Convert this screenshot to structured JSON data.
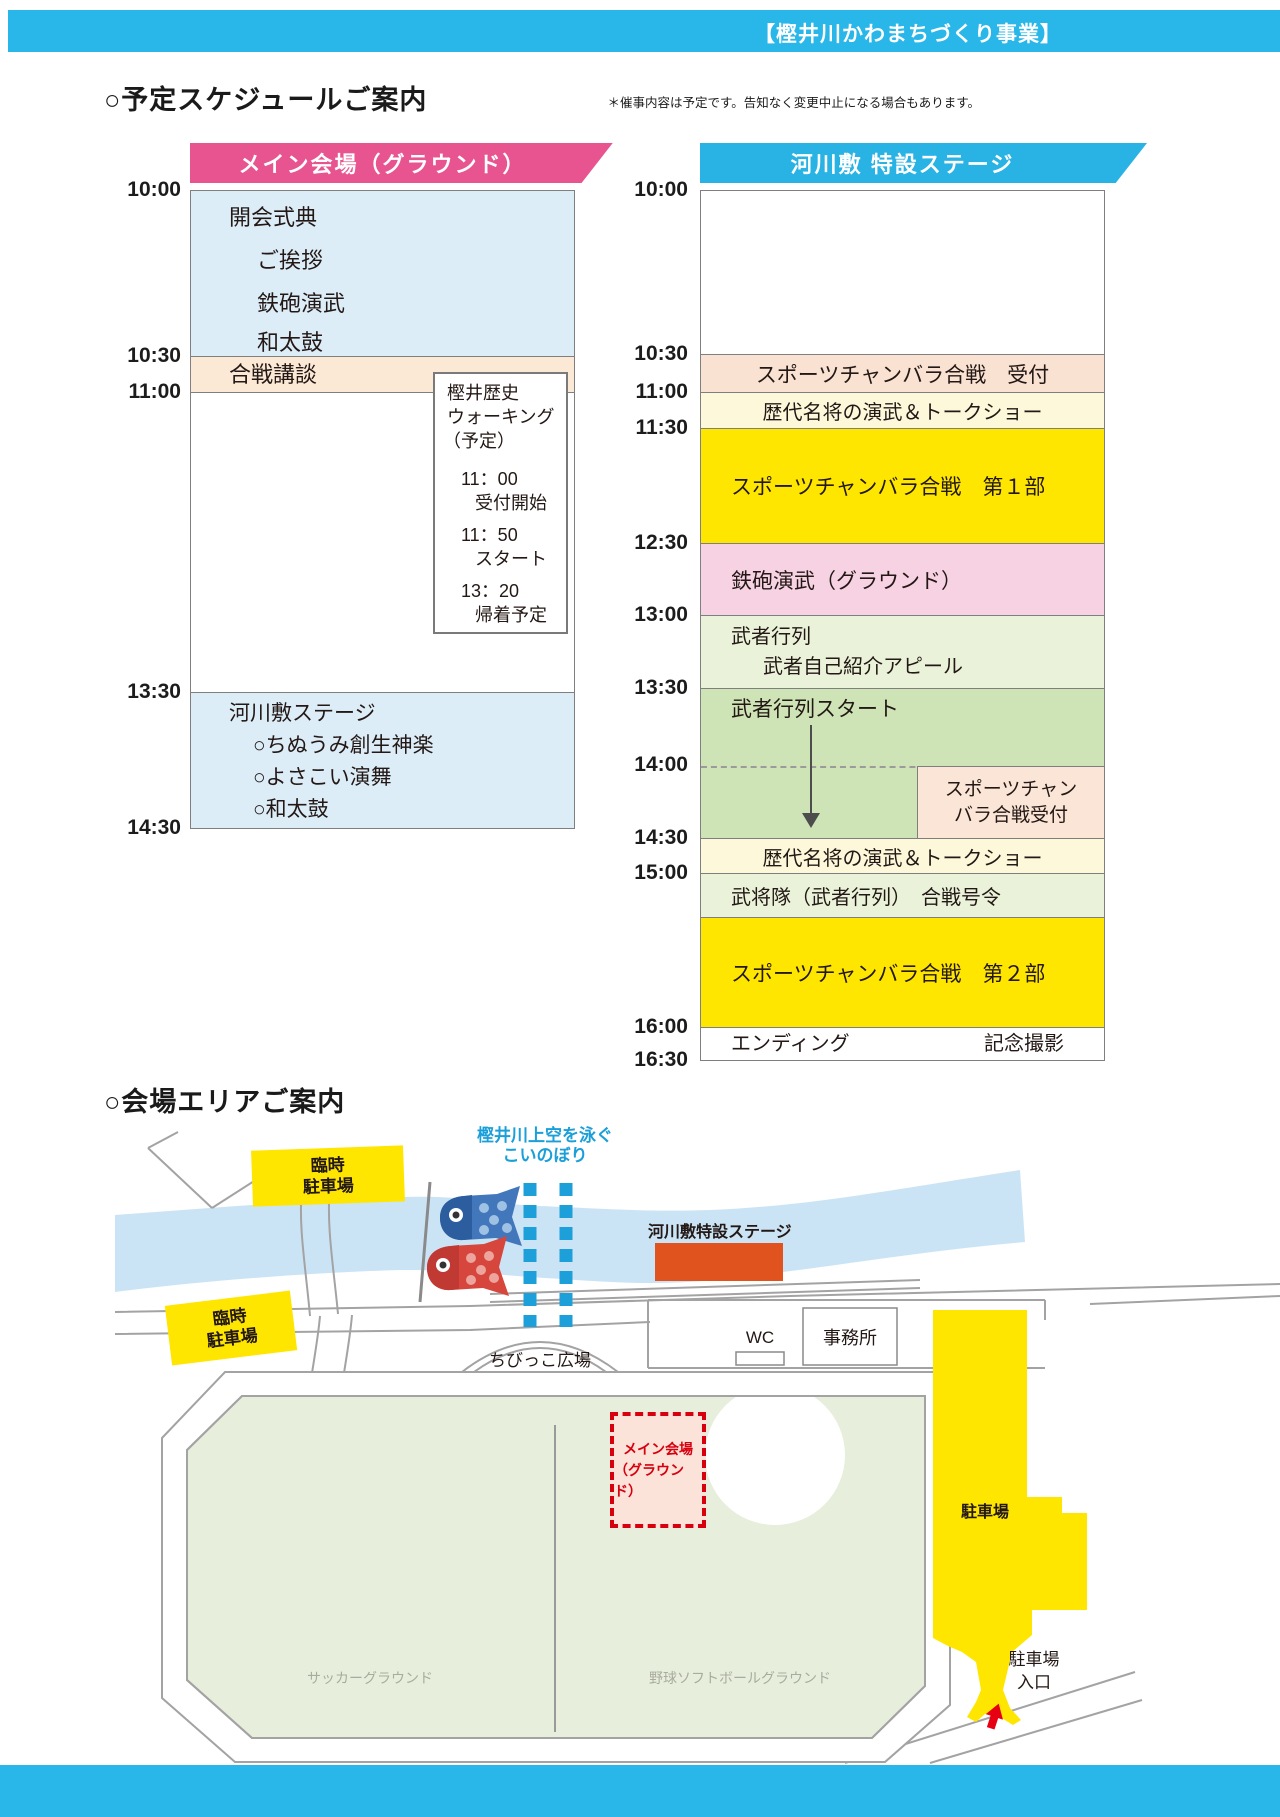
{
  "header": {
    "project_badge": "【樫井川かわまちづくり事業】"
  },
  "schedule": {
    "title": "○予定スケジュールご案内",
    "note": "＊催事内容は予定です。告知なく変更中止になる場合もあります。",
    "main_venue": {
      "banner": "メイン会場（グラウンド）",
      "time_labels": [
        "10:00",
        "10:30",
        "11:00",
        "13:30",
        "14:30"
      ],
      "opening_lines": [
        "開会式典",
        "ご挨拶",
        "鉄砲演武",
        "和太鼓"
      ],
      "kodan": "合戦講談",
      "walking_box": {
        "title_line1": "樫井歴史",
        "title_line2": "ウォーキング",
        "title_line3": "（予定）",
        "t1": "11：00",
        "l1": "受付開始",
        "t2": "11：50",
        "l2": "スタート",
        "t3": "13：20",
        "l3": "帰着予定"
      },
      "stage_block": [
        "河川敷ステージ",
        "○ちぬうみ創生神楽",
        "○よさこい演舞",
        "○和太鼓"
      ]
    },
    "river_stage": {
      "banner": "河川敷 特設ステージ",
      "time_labels": [
        "10:00",
        "10:30",
        "11:00",
        "11:30",
        "12:30",
        "13:00",
        "13:30",
        "14:00",
        "14:30",
        "15:00",
        "16:00",
        "16:30"
      ],
      "rows": {
        "reception1": "スポーツチャンバラ合戦　受付",
        "talkshow1": "歴代名将の演武＆トークショー",
        "chanbara1": "スポーツチャンバラ合戦　第１部",
        "teppo": "鉄砲演武（グラウンド）",
        "musha1a": "武者行列",
        "musha1b": "武者自己紹介アピール",
        "musha_start": "武者行列スタート",
        "reception2a": "スポーツチャン",
        "reception2b": "バラ合戦受付",
        "talkshow2": "歴代名将の演武＆トークショー",
        "bushotai": "武将隊（武者行列）　合戦号令",
        "chanbara2": "スポーツチャンバラ合戦　第２部",
        "ending": "エンディング",
        "photo": "記念撮影"
      }
    }
  },
  "map": {
    "title": "○会場エリアご案内",
    "temp_parking1_line1": "臨時",
    "temp_parking1_line2": "駐車場",
    "temp_parking2_line1": "臨時",
    "temp_parking2_line2": "駐車場",
    "koinobori_line1": "樫井川上空を泳ぐ",
    "koinobori_line2": "こいのぼり",
    "stage_label": "河川敷特設ステージ",
    "wc": "WC",
    "office": "事務所",
    "kids_plaza": "ちびっこ広場",
    "main_venue_line1": "メイン会場",
    "main_venue_line2": "（グラウンド）",
    "soccer": "サッカーグラウンド",
    "baseball": "野球ソフトボールグラウンド",
    "parking": "駐車場",
    "entrance_line1": "駐車場",
    "entrance_line2": "入口"
  },
  "colors": {
    "header_blue": "#29b6e8",
    "main_banner_pink": "#e8548f",
    "stage_banner_blue": "#29b3e4",
    "light_blue_block": "#dcedf8",
    "peach_block": "#fbe9d6",
    "pale_yellow_block": "#fdf8da",
    "highlight_yellow": "#ffe600",
    "pink_block": "#f6d2e2",
    "pale_green_block": "#eaf3da",
    "green_block": "#cee4b6",
    "river_blue": "#cbe4f5",
    "field_green": "#e7efdc",
    "stage_orange": "#e0531f",
    "map_red": "#d7000f",
    "map_label_blue": "#1b9fd8"
  }
}
